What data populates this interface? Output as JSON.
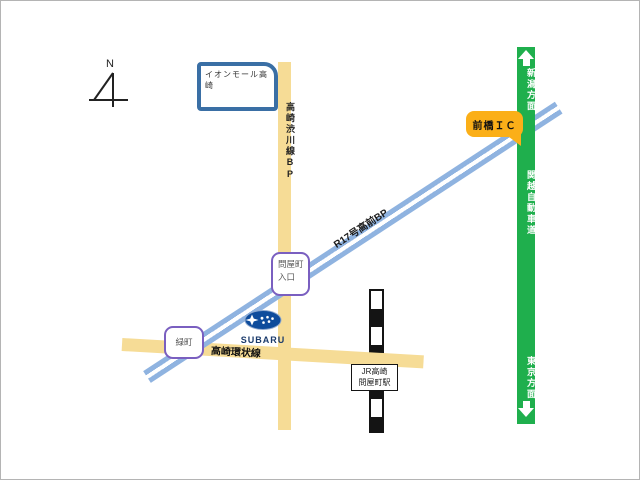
{
  "colors": {
    "road_yellow": "#F6DC96",
    "road_blue": "#8FB3E0",
    "expressway_green": "#1FAF4D",
    "badge_orange": "#FBAF18",
    "aeon_border": "#3A6FA5",
    "marker_purple": "#7A5FC0",
    "subaru_blue": "#0E4C9C",
    "text_dark": "#222222"
  },
  "compass": {
    "north_label": "N"
  },
  "landmarks": {
    "aeon_mall": {
      "label": "イオンモール高崎"
    },
    "subaru_dealer": {
      "logo_text": "SUBARU"
    },
    "station": {
      "line1": "JR高崎",
      "line2": "問屋町駅"
    }
  },
  "roads": {
    "takasaki_shibukawa_bp": {
      "label": "高崎渋川線BP"
    },
    "takasaki_loop": {
      "label": "高崎環状線"
    },
    "r17_takamae_bp": {
      "label": "R17号高前BP"
    },
    "kanetsu_expressway": {
      "label": "関越自動車道"
    },
    "niigata_direction": {
      "label": "新潟方面"
    },
    "tokyo_direction": {
      "label": "東京方面"
    }
  },
  "markers": {
    "maebashi_ic": {
      "label": "前橋ＩＣ"
    },
    "tonyamachi_entrance": {
      "line1": "問屋町",
      "line2": "入口"
    },
    "midoricho": {
      "label": "緑町"
    }
  }
}
